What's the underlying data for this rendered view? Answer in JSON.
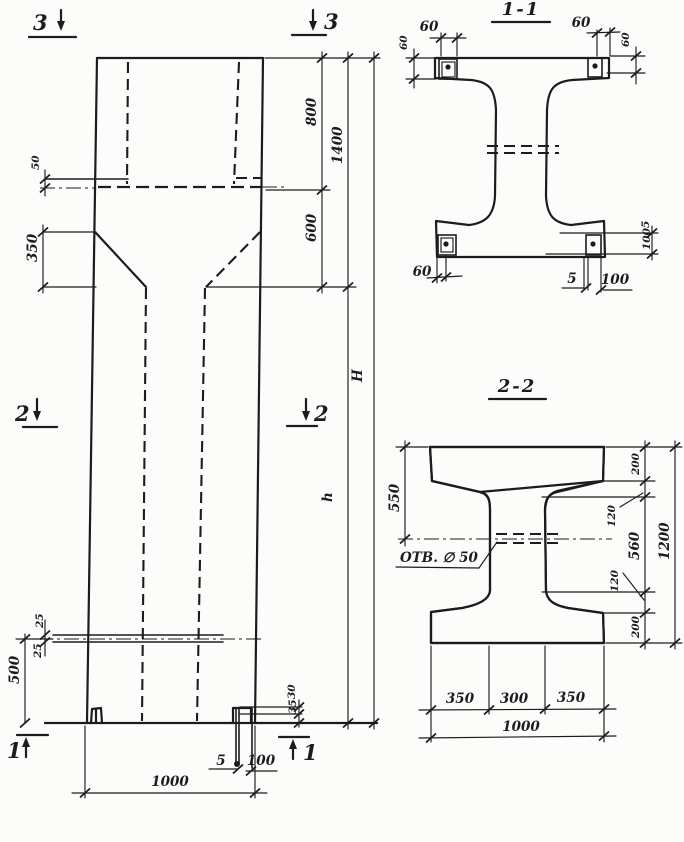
{
  "colors": {
    "paper": "#fcfcfa",
    "ink": "#1c1c1c"
  },
  "markers": {
    "top_left": "3",
    "top_right": "3",
    "mid_left": "2",
    "mid_right": "2",
    "bottom_left": "1",
    "bottom_right": "1"
  },
  "elevation": {
    "dims": {
      "ledge_offset": "50",
      "haunch_height": "350",
      "head_upper": "800",
      "head_total": "1400",
      "head_lower": "600",
      "total_height": "H",
      "shaft_height": "h",
      "hole_gap_top": "25",
      "hole_gap_bottom": "25",
      "hole_elevation": "500",
      "foot_dim_top": "30",
      "foot_dim_bottom": "35",
      "base_plate_thickness": "5",
      "base_plate_width": "100",
      "column_width": "1000"
    }
  },
  "section_1_1": {
    "title": "1-1",
    "dims": {
      "plate_top_left": "60",
      "plate_top_right": "60",
      "plate_left": "60",
      "plate_right": "60",
      "plate_bottom_left": "60",
      "bottom_thickness": "5",
      "bottom_width": "100",
      "right_thickness": "5",
      "right_width": "100"
    }
  },
  "section_2_2": {
    "title": "2-2",
    "hole_label": "ОТВ. ∅ 50",
    "dims": {
      "flange_to_hole": "550",
      "flange_top": "200",
      "haunch_top": "120",
      "web_clear": "560",
      "haunch_bottom": "120",
      "flange_bottom": "200",
      "total_depth": "1200",
      "bottom_left": "350",
      "bottom_mid": "300",
      "bottom_right": "350",
      "bottom_total": "1000"
    }
  }
}
